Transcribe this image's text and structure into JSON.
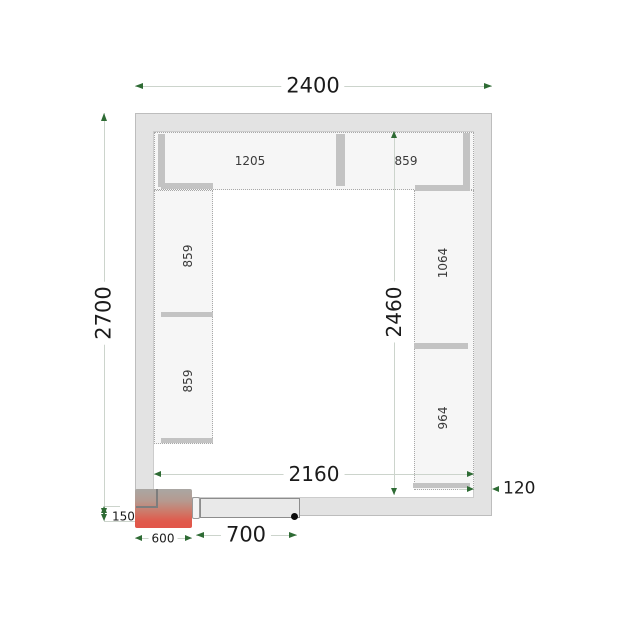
{
  "drawing": {
    "type": "cold-room-floor-plan-top-view",
    "dimensions": {
      "outer_width": "2400",
      "outer_height": "2700",
      "inner_width": "2160",
      "inner_height": "2460",
      "wall_thickness": "120",
      "door_width": "700",
      "cooling_unit_width": "600",
      "cooling_unit_offset": "150"
    },
    "shelves": {
      "top_row": [
        {
          "length": "1205"
        },
        {
          "length": "859"
        }
      ],
      "left_column": [
        {
          "length": "859"
        },
        {
          "length": "859"
        }
      ],
      "right_column": [
        {
          "length": "1064"
        },
        {
          "length": "964"
        }
      ]
    },
    "colors": {
      "wall_fill": "#e3e3e3",
      "shelf_fill": "#f6f6f6",
      "shelf_edge": "#c3c3c3",
      "dimension_line": "#ccd4cc",
      "dimension_arrow": "#2e6b34",
      "cooling_unit_red": "#e2564a",
      "text": "#1b1b1b"
    }
  }
}
